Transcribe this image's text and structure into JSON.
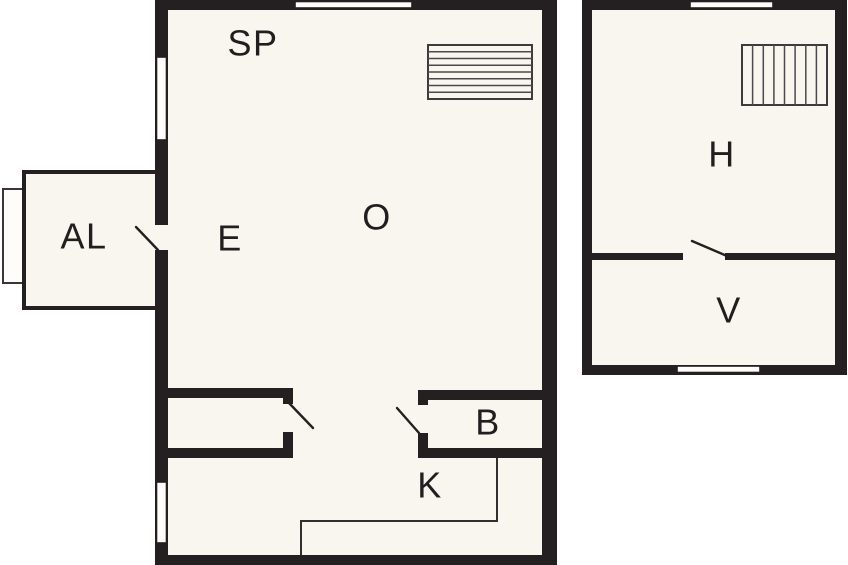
{
  "page": {
    "background": "#ffffff"
  },
  "colors": {
    "wall": "#241f20",
    "floor": "#f8f6ef",
    "window": "#fefdfa",
    "label_text": "#221e1f"
  },
  "main_building": {
    "labels": {
      "sp": "SP",
      "al": "AL",
      "e": "E",
      "o": "O",
      "b": "B",
      "k": "K"
    }
  },
  "outbuilding": {
    "labels": {
      "h": "H",
      "v": "V"
    }
  }
}
